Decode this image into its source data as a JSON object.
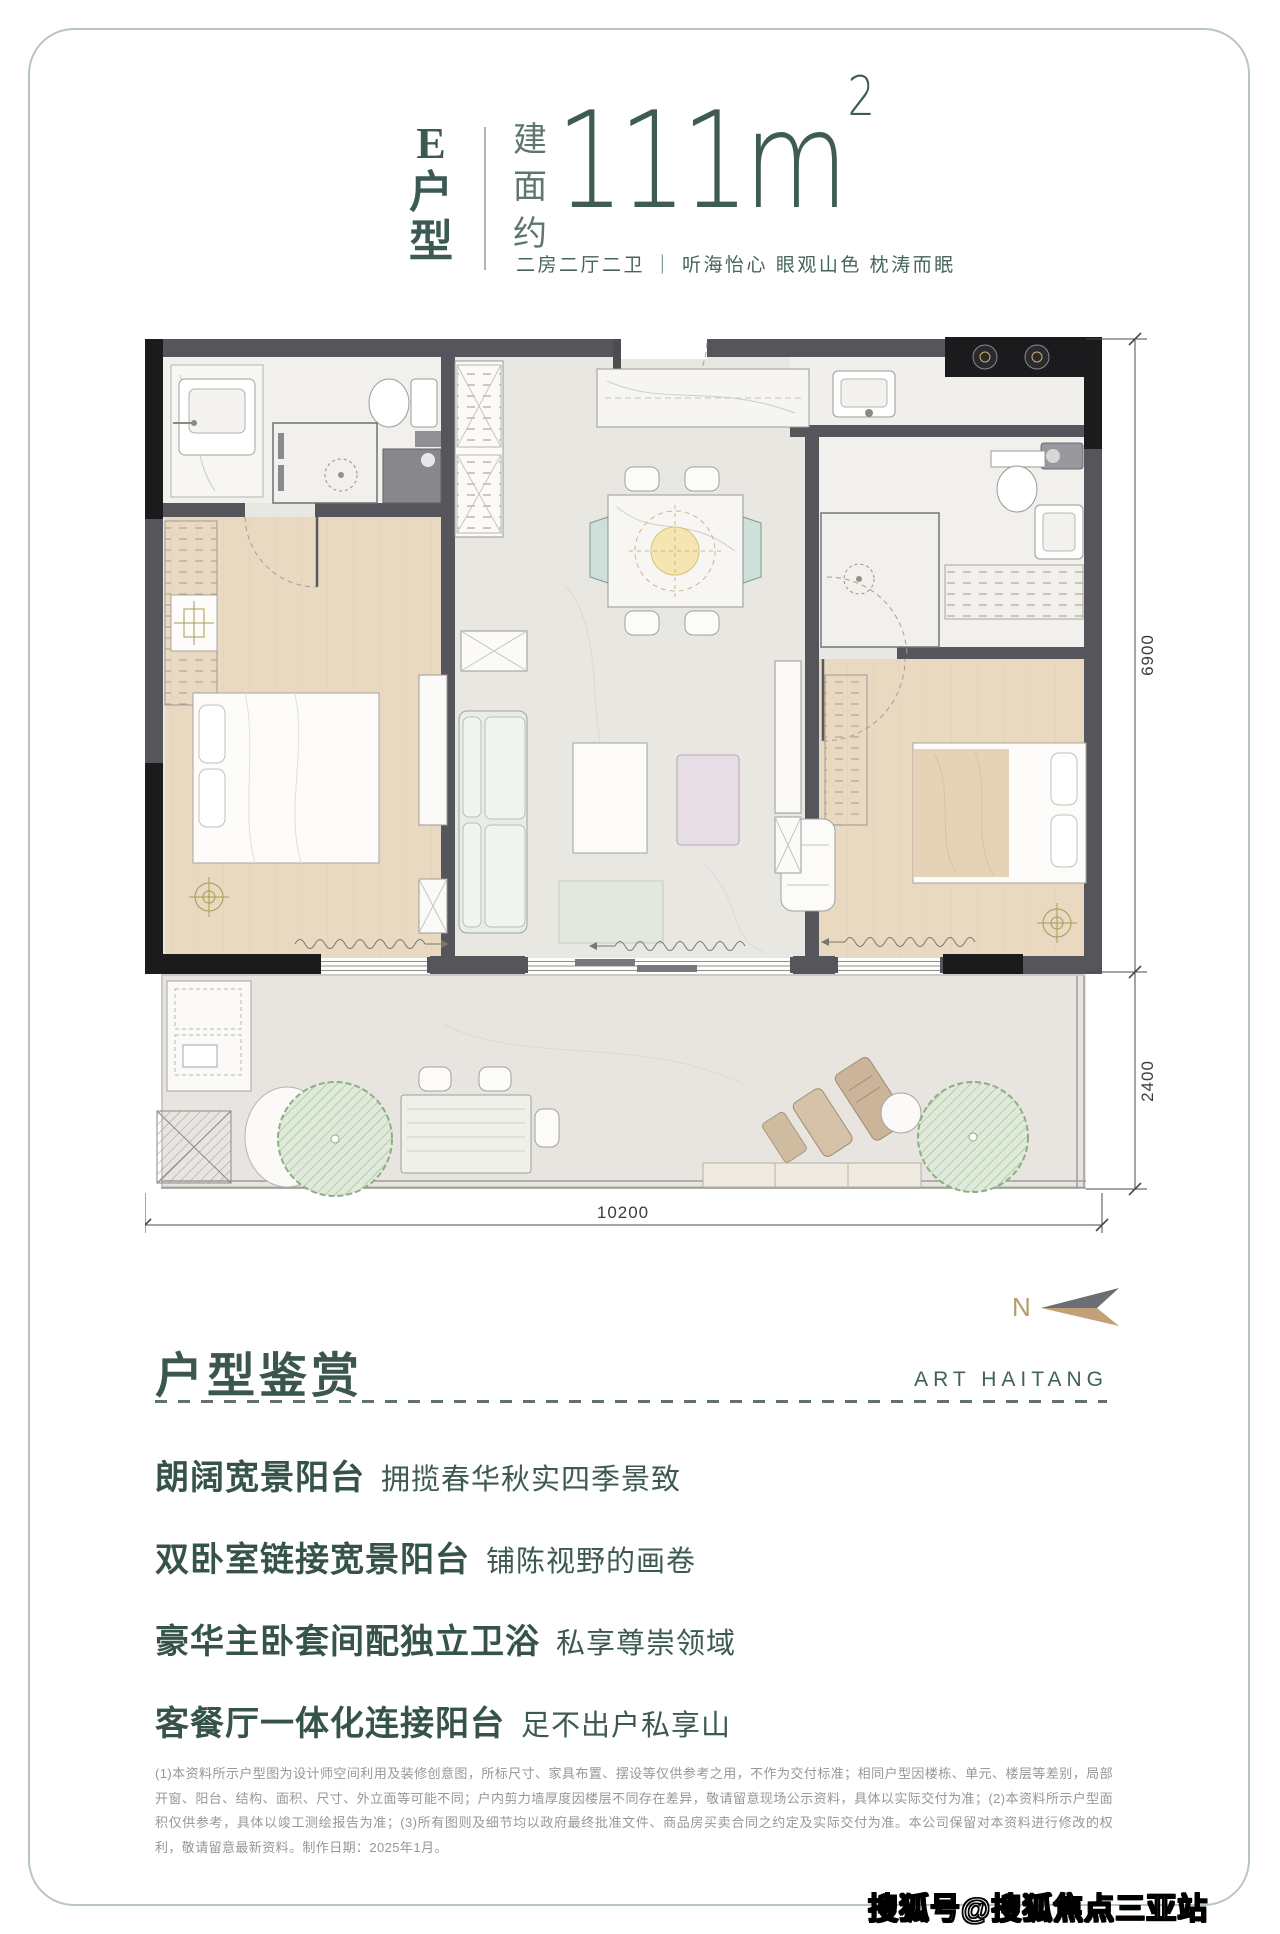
{
  "header": {
    "unit_chars": [
      "E",
      "户",
      "型"
    ],
    "area_prefix_chars": [
      "建",
      "面",
      "约"
    ],
    "area_value": "111m",
    "area_sup": "2",
    "tagline": "二房二厅二卫 ｜ 听海怡心 眼观山色 枕涛而眠"
  },
  "floorplan": {
    "dim_right_top": "6900",
    "dim_right_bottom": "2400",
    "dim_bottom": "10200",
    "compass_label": "N"
  },
  "section": {
    "heading": "户型鉴赏",
    "brand": "ART HAITANG",
    "features": [
      {
        "highlight": "朗阔宽景阳台",
        "desc": "拥揽春华秋实四季景致"
      },
      {
        "highlight": "双卧室链接宽景阳台",
        "desc": "铺陈视野的画卷"
      },
      {
        "highlight": "豪华主卧套间配独立卫浴",
        "desc": "私享尊崇领域"
      },
      {
        "highlight": "客餐厅一体化连接阳台",
        "desc": "足不出户私享山"
      }
    ]
  },
  "disclaimer": "(1)本资料所示户型图为设计师空间利用及装修创意图，所标尺寸、家具布置、摆设等仅供参考之用，不作为交付标准；相同户型因楼栋、单元、楼层等差别，局部开窗、阳台、结构、面积、尺寸、外立面等可能不同；户内剪力墙厚度因楼层不同存在差异，敬请留意现场公示资料，具体以实际交付为准；(2)本资料所示户型面积仅供参考，具体以竣工测绘报告为准；(3)所有图则及细节均以政府最终批准文件、商品房买卖合同之约定及实际交付为准。本公司保留对本资料进行修改的权利，敬请留意最新资料。制作日期：2025年1月。",
  "watermark": "搜狐号@搜狐焦点三亚站",
  "colors": {
    "accent_teal": "#3c5a53",
    "frame": "#b7c6c0",
    "wall": "#55565b",
    "wood_floor": "#ead9c1",
    "plant_green": "#a3c296",
    "compass_tan": "#c2a178",
    "compass_gray": "#6d6d74"
  }
}
